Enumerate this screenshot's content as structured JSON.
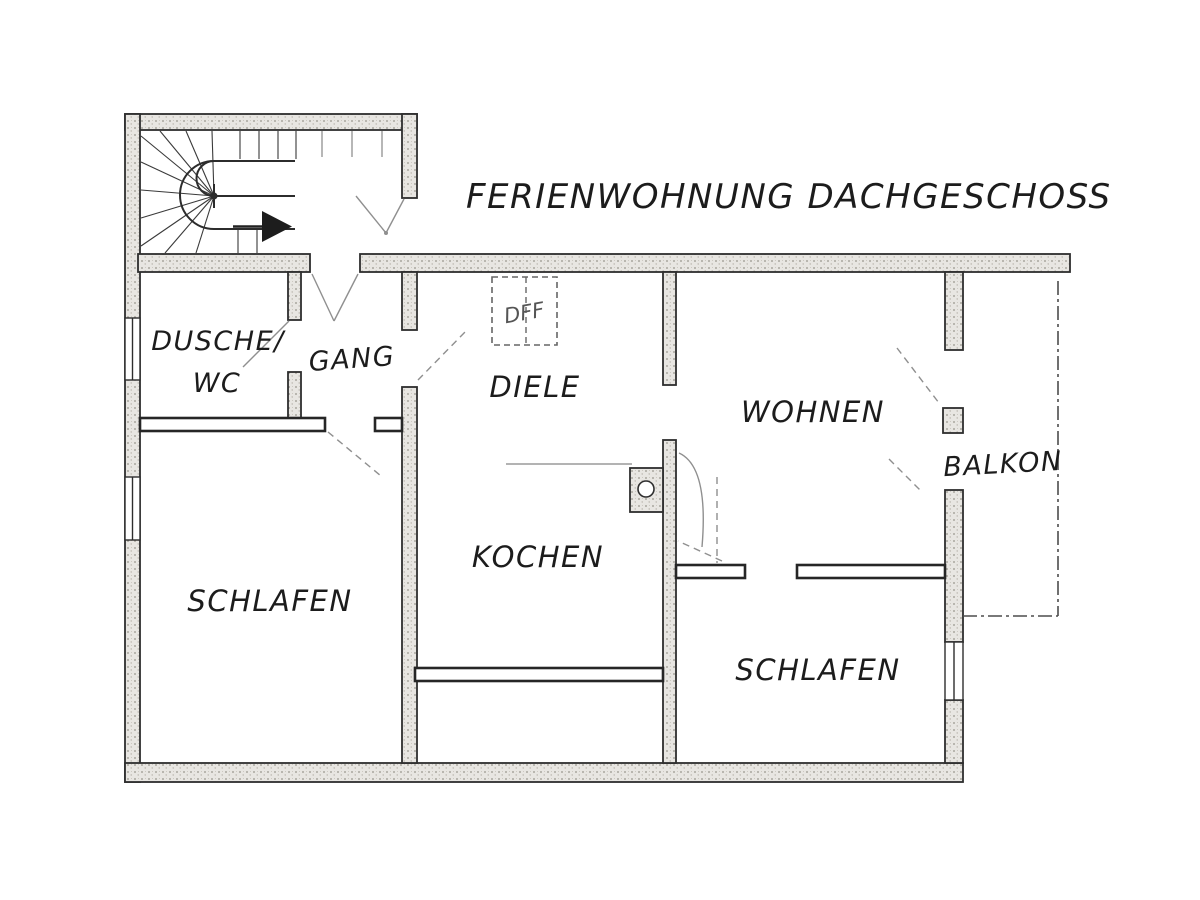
{
  "title": "FERIENWOHNUNG DACHGESCHOSS",
  "rooms": {
    "dusche_wc": {
      "line1": "DUSCHE/",
      "line2": "WC"
    },
    "gang": {
      "label": "GANG"
    },
    "diele": {
      "label": "DIELE"
    },
    "kochen": {
      "label": "KOCHEN"
    },
    "wohnen": {
      "label": "WOHNEN"
    },
    "balkon": {
      "label": "BALKON"
    },
    "schlafen_west": {
      "label": "SCHLAFEN"
    },
    "schlafen_east": {
      "label": "SCHLAFEN"
    }
  },
  "annotations": {
    "roof_window": "DFF"
  },
  "symbols": {
    "stair_direction_arrow": "arrow-right",
    "stove_sink_unit": "square-with-circle",
    "staircase": "u-turn-winder-stair"
  },
  "colors": {
    "paper": "#ffffff",
    "ink": "#2e2e2e",
    "wall_fill": "#e8e6e2",
    "swing_line": "#8f8f8f"
  }
}
